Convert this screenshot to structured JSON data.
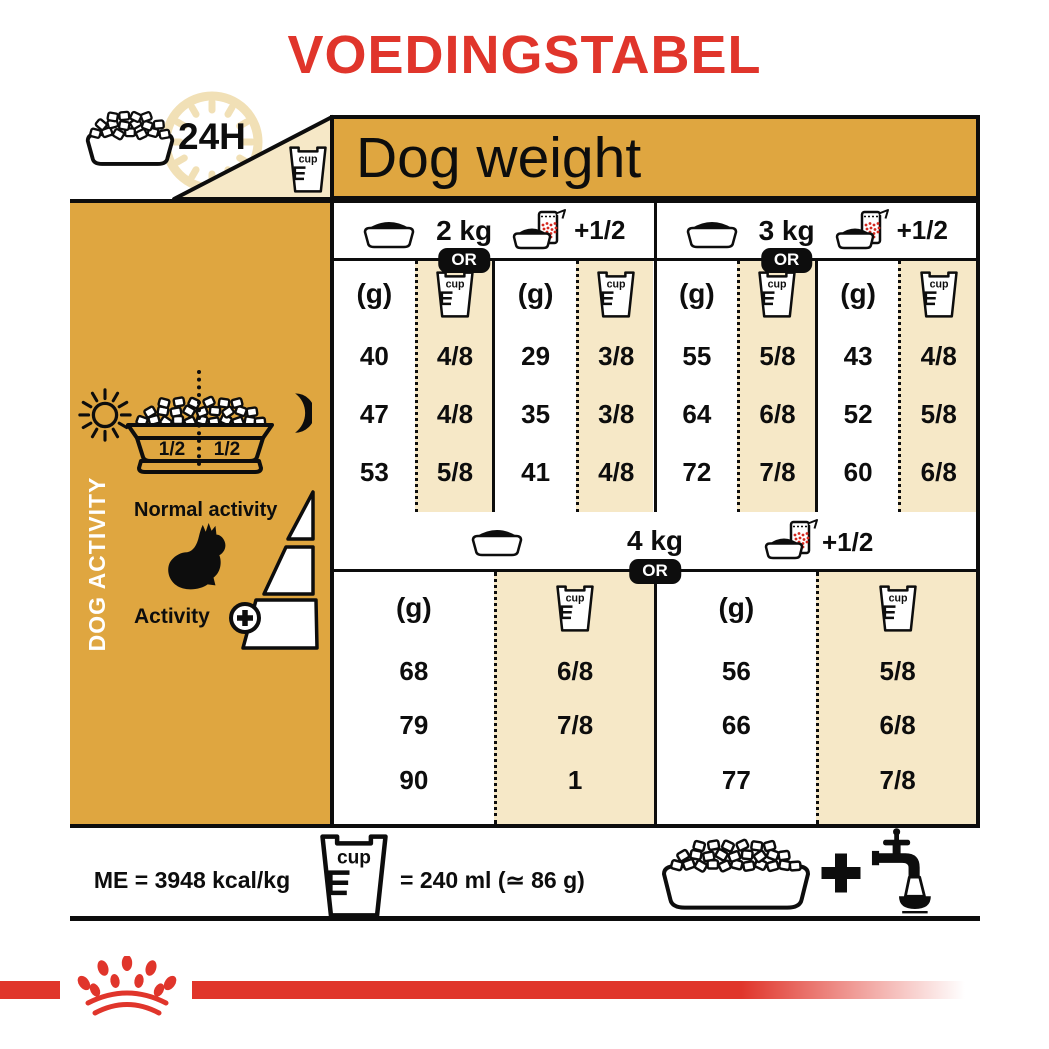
{
  "title": "VOEDINGSTABEL",
  "header": {
    "hours_label": "24H",
    "dog_weight_label": "Dog weight",
    "cup_label": "cup"
  },
  "sidebar": {
    "dog_activity_label": "DOG ACTIVITY",
    "bowl_half_left": "1/2",
    "bowl_half_right": "1/2",
    "normal_activity_label": "Normal activity",
    "activity_label": "Activity"
  },
  "table": {
    "grams_header": "(g)",
    "cup_header": "cup",
    "or_label": "OR",
    "plus_half_label": "+1/2",
    "blocks": [
      {
        "weight_label": "2 kg",
        "subtables": [
          {
            "grams": [
              "40",
              "47",
              "53"
            ],
            "cups": [
              "4/8",
              "4/8",
              "5/8"
            ]
          },
          {
            "grams": [
              "29",
              "35",
              "41"
            ],
            "cups": [
              "3/8",
              "3/8",
              "4/8"
            ]
          }
        ]
      },
      {
        "weight_label": "3 kg",
        "subtables": [
          {
            "grams": [
              "55",
              "64",
              "72"
            ],
            "cups": [
              "5/8",
              "6/8",
              "7/8"
            ]
          },
          {
            "grams": [
              "43",
              "52",
              "60"
            ],
            "cups": [
              "4/8",
              "5/8",
              "6/8"
            ]
          }
        ]
      },
      {
        "weight_label": "4 kg",
        "subtables": [
          {
            "grams": [
              "68",
              "79",
              "90"
            ],
            "cups": [
              "6/8",
              "7/8",
              "1"
            ]
          },
          {
            "grams": [
              "56",
              "66",
              "77"
            ],
            "cups": [
              "5/8",
              "6/8",
              "7/8"
            ]
          }
        ]
      }
    ]
  },
  "footer": {
    "me_label": "ME = 3948 kcal/kg",
    "cup_equals_label": "= 240 ml (≃ 86 g)"
  },
  "icons": [
    "kibble-bowl-icon",
    "clock-24h-icon",
    "measuring-cup-icon",
    "empty-bowl-icon",
    "bowl-with-pouch-icon",
    "sun-icon",
    "moon-icon",
    "dog-silhouette-icon",
    "activity-ramp-icon",
    "plus-circle-icon",
    "plus-icon",
    "water-tap-icon",
    "crown-paw-logo"
  ],
  "colors": {
    "brand_red": "#E0352B",
    "gold": "#DFA640",
    "cream": "#F6E8C7"
  }
}
